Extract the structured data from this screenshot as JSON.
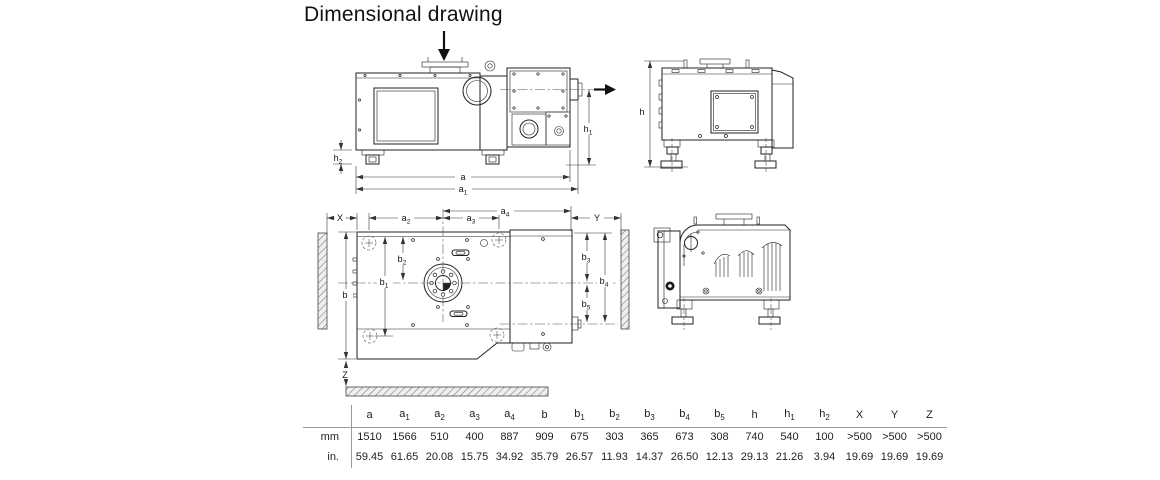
{
  "title": "Dimensional drawing",
  "colors": {
    "text": "#111111",
    "line": "#222222",
    "rule": "#9a9a9a"
  },
  "dims": {
    "a": {
      "base": "a",
      "sub": ""
    },
    "a1": {
      "base": "a",
      "sub": "1"
    },
    "a2": {
      "base": "a",
      "sub": "2"
    },
    "a3": {
      "base": "a",
      "sub": "3"
    },
    "a4": {
      "base": "a",
      "sub": "4"
    },
    "b": {
      "base": "b",
      "sub": ""
    },
    "b1": {
      "base": "b",
      "sub": "1"
    },
    "b2": {
      "base": "b",
      "sub": "2"
    },
    "b3": {
      "base": "b",
      "sub": "3"
    },
    "b4": {
      "base": "b",
      "sub": "4"
    },
    "b5": {
      "base": "b",
      "sub": "5"
    },
    "h": {
      "base": "h",
      "sub": ""
    },
    "h1": {
      "base": "h",
      "sub": "1"
    },
    "h2": {
      "base": "h",
      "sub": "2"
    },
    "X": {
      "base": "X",
      "sub": ""
    },
    "Y": {
      "base": "Y",
      "sub": ""
    },
    "Z": {
      "base": "Z",
      "sub": ""
    }
  },
  "table": {
    "row_headers": [
      "mm",
      "in."
    ],
    "columns": [
      "a",
      "a1",
      "a2",
      "a3",
      "a4",
      "b",
      "b1",
      "b2",
      "b3",
      "b4",
      "b5",
      "h",
      "h1",
      "h2",
      "X",
      "Y",
      "Z"
    ],
    "rows": {
      "mm": [
        "1510",
        "1566",
        "510",
        "400",
        "887",
        "909",
        "675",
        "303",
        "365",
        "673",
        "308",
        "740",
        "540",
        "100",
        ">500",
        ">500",
        ">500"
      ],
      "in": [
        "59.45",
        "61.65",
        "20.08",
        "15.75",
        "34.92",
        "35.79",
        "26.57",
        "11.93",
        "14.37",
        "26.50",
        "12.13",
        "29.13",
        "21.26",
        "3.94",
        "19.69",
        "19.69",
        "19.69"
      ]
    }
  }
}
